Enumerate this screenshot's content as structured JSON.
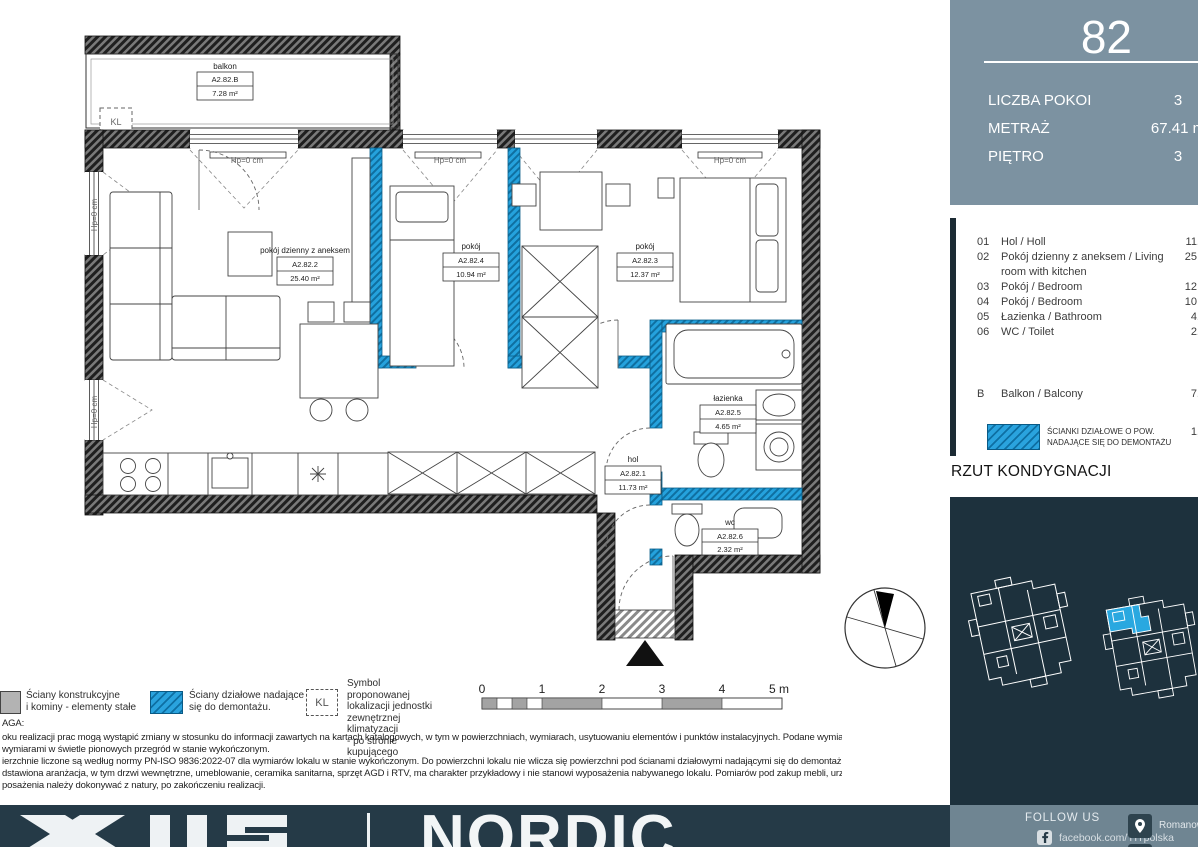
{
  "sidebar": {
    "apartment_number": "82",
    "stats": [
      {
        "label": "LICZBA POKOI",
        "value": "3"
      },
      {
        "label": "METRAŻ",
        "value": "67.41 m"
      },
      {
        "label": "PIĘTRO",
        "value": "3"
      }
    ],
    "rooms": [
      {
        "no": "01",
        "name": "Hol / Holl",
        "area": "11."
      },
      {
        "no": "02",
        "name": "Pokój dzienny z aneksem / Living room with kitchen",
        "area": "25."
      },
      {
        "no": "03",
        "name": "Pokój / Bedroom",
        "area": "12."
      },
      {
        "no": "04",
        "name": "Pokój / Bedroom",
        "area": "10."
      },
      {
        "no": "05",
        "name": "Łazienka / Bathroom",
        "area": "4."
      },
      {
        "no": "06",
        "name": "WC / Toilet",
        "area": "2."
      }
    ],
    "balcony_row": {
      "no": "B",
      "name": "Balkon / Balcony",
      "area": "7."
    },
    "partition_note": {
      "line1": "ŚCIANKI DZIAŁOWE O POW.",
      "line2": "NADAJĄCE SIĘ DO DEMONTAŻU",
      "area": "1,"
    },
    "section_title": "RZUT KONDYGNACJI"
  },
  "plan": {
    "hp_label": "Hp=0 cm",
    "kl_symbol": "KL",
    "labels": {
      "balkon": {
        "name": "balkon",
        "code": "A2.82.B",
        "area": "7.28 m²"
      },
      "living": {
        "name": "pokój dzienny z aneksem",
        "code": "A2.82.2",
        "area": "25.40 m²"
      },
      "pokoj4": {
        "name": "pokój",
        "code": "A2.82.4",
        "area": "10.94 m²"
      },
      "pokoj3": {
        "name": "pokój",
        "code": "A2.82.3",
        "area": "12.37 m²"
      },
      "lazienka": {
        "name": "łazienka",
        "code": "A2.82.5",
        "area": "4.65 m²"
      },
      "hol": {
        "name": "hol",
        "code": "A2.82.1",
        "area": "11.73 m²"
      },
      "wc": {
        "name": "wc",
        "code": "A2.82.6",
        "area": "2.32 m²"
      }
    }
  },
  "legend": {
    "walls": {
      "line1": "Ściany konstrukcyjne",
      "line2": "i kominy - elementy stałe"
    },
    "partitions": {
      "line1": "Ściany działowe nadające",
      "line2": "się do demontażu."
    },
    "ac": {
      "symbol": "KL",
      "line1": "Symbol proponowanej",
      "line2": "lokalizacji jednostki",
      "line3": "zewnętrznej klimatyzacji",
      "line4": "- po stronie kupującego"
    }
  },
  "scalebar": {
    "t0": "0",
    "t1": "1",
    "t2": "2",
    "t3": "3",
    "t4": "4",
    "t5": "5 m"
  },
  "notes": {
    "heading": "AGA:",
    "lines": [
      "oku realizacji prac mogą wystąpić zmiany w stosunku do informacji zawartych na kartach katalogowych, w tym w powierzchniach, wymiarach, usytuowaniu elementów i punktów instalacyjnych. Podane wymiary",
      "wymiarami w świetle pionowych przegród w stanie wykończonym.",
      "ierzchnie liczone są według normy PN-ISO 9836:2022-07 dla wymiarów lokalu w stanie wykończonym. Do powierzchni lokalu nie wlicza się powierzchni pod ścianami działowymi nadającymi się do demontażu.",
      "dstawiona aranżacja, w tym drzwi wewnętrzne, umeblowanie, ceramika sanitarna, sprzęt AGD i RTV, ma charakter przykładowy i nie stanowi wyposażenia nabywanego lokalu. Pomiarów pod zakup mebli, urządzeń",
      "posażenia należy dokonywać z natury, po zakończeniu realizacji."
    ]
  },
  "footer": {
    "brand": "NORDIC",
    "follow_label": "FOLLOW US",
    "facebook_handle": "facebook.com/YITpolska",
    "address": "Romanowicza"
  },
  "colors": {
    "accent_blue": "#1f9cd9",
    "slate_panel": "#7c92a1",
    "navy_panel": "#1d313d",
    "footer_navy": "#253a47",
    "footer_slate": "#6f8592"
  }
}
